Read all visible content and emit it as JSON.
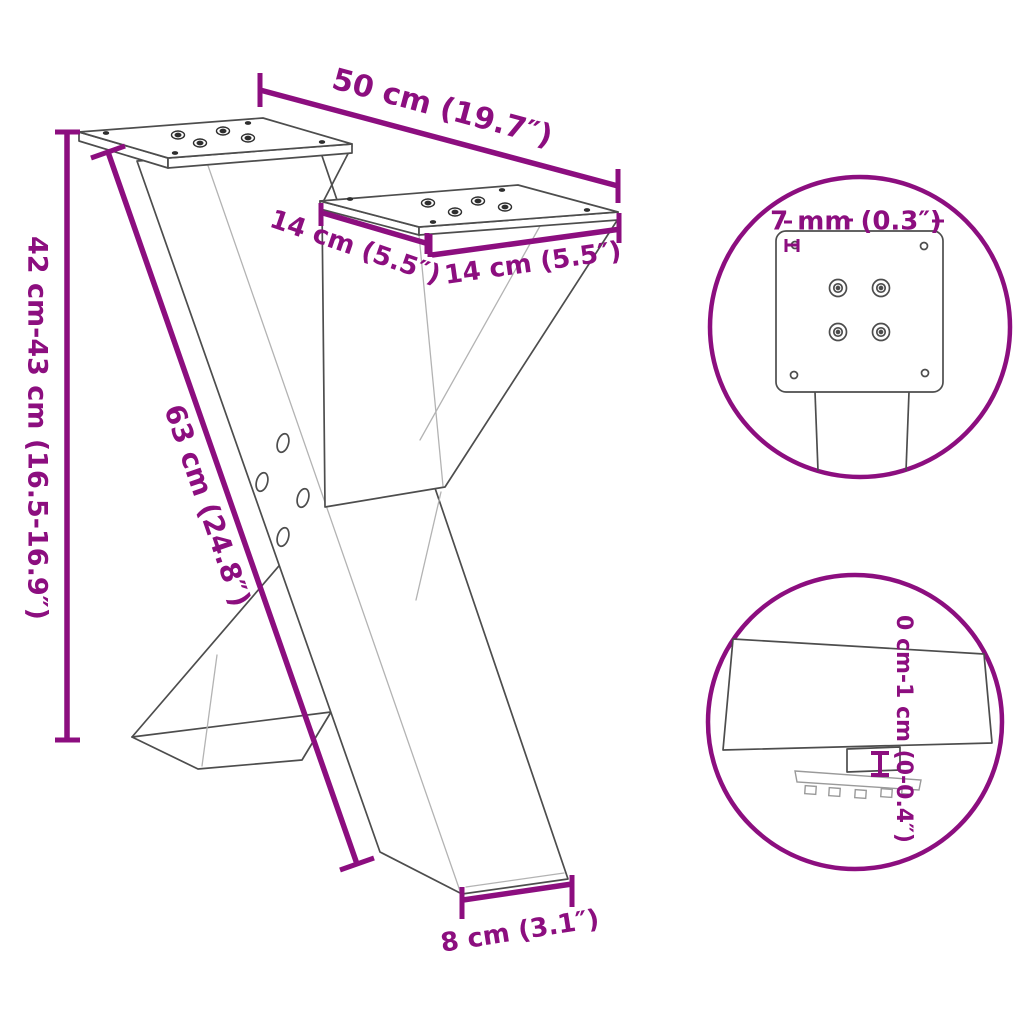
{
  "image_type": "product-dimension-diagram",
  "subject": "x-shaped-table-leg",
  "colors": {
    "accent": "#8C0E7F",
    "line": "#4d4d4d",
    "light_line": "#b3b3b3",
    "background": "#ffffff"
  },
  "dimensions": {
    "width": {
      "label": "50 cm (19.7″)"
    },
    "height": {
      "label": "42 cm-43 cm (16.5-16.9″)"
    },
    "beam_length": {
      "label": "63 cm (24.8″)"
    },
    "plate_depth": {
      "label": "14 cm (5.5″)"
    },
    "plate_width": {
      "label": "14 cm (5.5″)"
    },
    "foot_width": {
      "label": "8 cm (3.1″)"
    }
  },
  "details": {
    "plate_thickness": {
      "label": "7 mm (0.3″)"
    },
    "height_adjustment": {
      "label": "0 cm-1 cm (0-0.4″)"
    }
  }
}
